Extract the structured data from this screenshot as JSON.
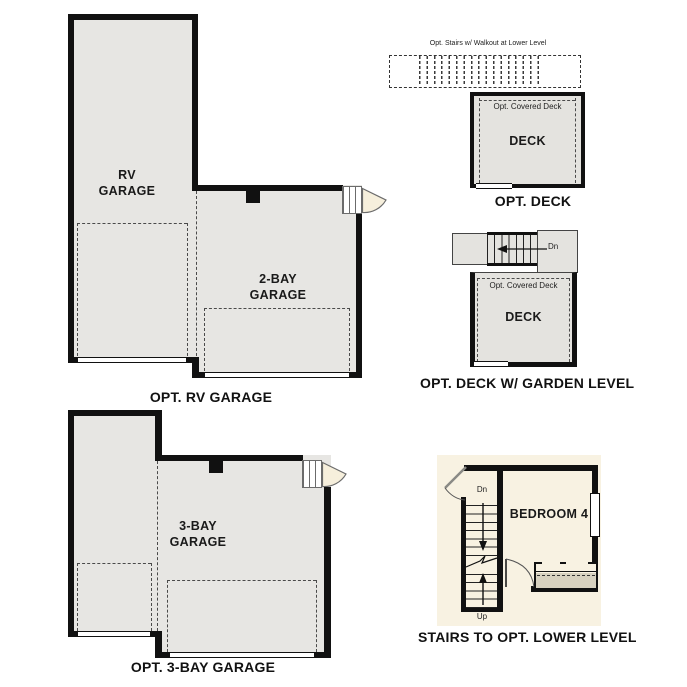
{
  "colors": {
    "wall": "#111111",
    "garage_fill": "#e7e6e3",
    "deck_fill": "#e4e3df",
    "panel_beige": "#f8f2e2",
    "door_beige": "#f6efdc",
    "closet_band": "#d7d1bf"
  },
  "rv_plan": {
    "rv_label": "RV GARAGE",
    "bay2_label": "2-BAY GARAGE",
    "caption": "OPT. RV GARAGE"
  },
  "deck_plan": {
    "stairs_note": "Opt. Stairs w/ Walkout at Lower Level",
    "covered_label": "Opt. Covered Deck",
    "deck_label": "DECK",
    "caption": "OPT. DECK"
  },
  "garden_deck_plan": {
    "dn_label": "Dn",
    "covered_label": "Opt. Covered Deck",
    "deck_label": "DECK",
    "caption": "OPT. DECK W/ GARDEN LEVEL"
  },
  "bay3_plan": {
    "garage_label": "3-BAY GARAGE",
    "caption": "OPT. 3-BAY GARAGE"
  },
  "stairs_plan": {
    "dn_label": "Dn",
    "up_label": "Up",
    "bedroom_label": "BEDROOM 4",
    "caption": "STAIRS TO OPT. LOWER LEVEL"
  }
}
